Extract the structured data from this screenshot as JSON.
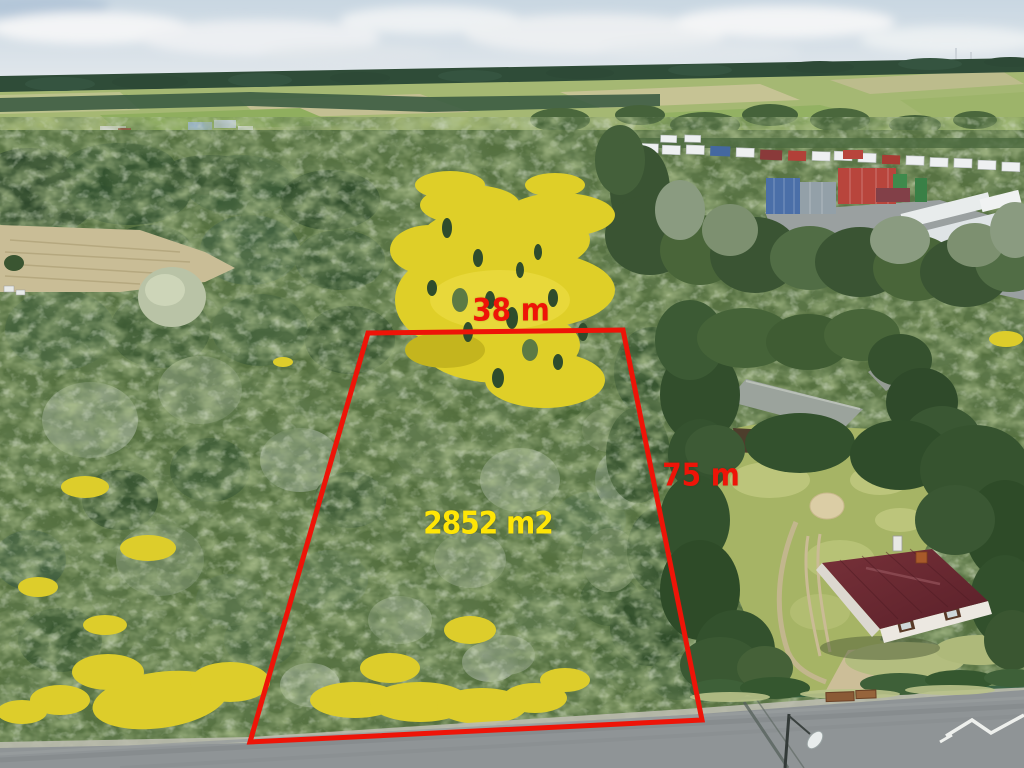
{
  "annotations": {
    "width_label": "38 m",
    "depth_label": "75 m",
    "area_label": "2852 m2"
  },
  "colors": {
    "boundary_red": "#ee1408",
    "area_yellow": "#ffe606"
  },
  "scene_landmarks": {
    "plot": "outlined-forest-parcel",
    "flowers": "yellow-goldenrod-patches",
    "buildings": [
      "white-house-dark-red-roof",
      "gray-roof-barn",
      "container-truck-depot",
      "distant-village-red-roofs"
    ],
    "road": "asphalt-road-bottom",
    "background": "fields-forest-horizon-cloudy-sky"
  }
}
